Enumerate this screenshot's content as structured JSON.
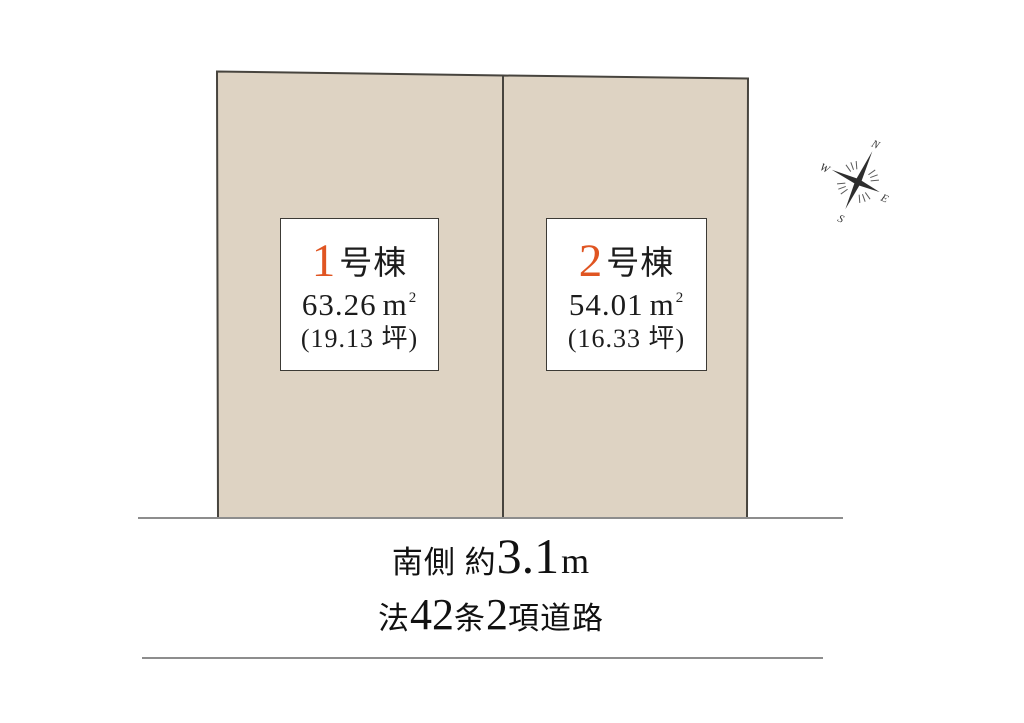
{
  "colors": {
    "background": "#ffffff",
    "parcel_fill": "#ded3c3",
    "parcel_stroke": "#47443e",
    "road_line": "#8d8d8d",
    "label_box_border": "#3c3a35",
    "text": "#1c1c1c",
    "accent_orange": "#e05522"
  },
  "lots": [
    {
      "number": "1",
      "suffix": "号棟",
      "area": "63.26",
      "unit_base": "m",
      "unit_sup": "2",
      "tsubo": "(19.13 坪)"
    },
    {
      "number": "2",
      "suffix": "号棟",
      "area": "54.01",
      "unit_base": "m",
      "unit_sup": "2",
      "tsubo": "(16.33 坪)"
    }
  ],
  "road": {
    "south_label": "南側 約",
    "south_width": "3.1",
    "south_unit": "m",
    "law_prefix": "法",
    "law_article": "42",
    "law_jou": "条",
    "law_item": "2",
    "law_suffix": "項道路"
  },
  "compass": {
    "north": "N",
    "east": "E",
    "south": "S",
    "west": "W"
  }
}
